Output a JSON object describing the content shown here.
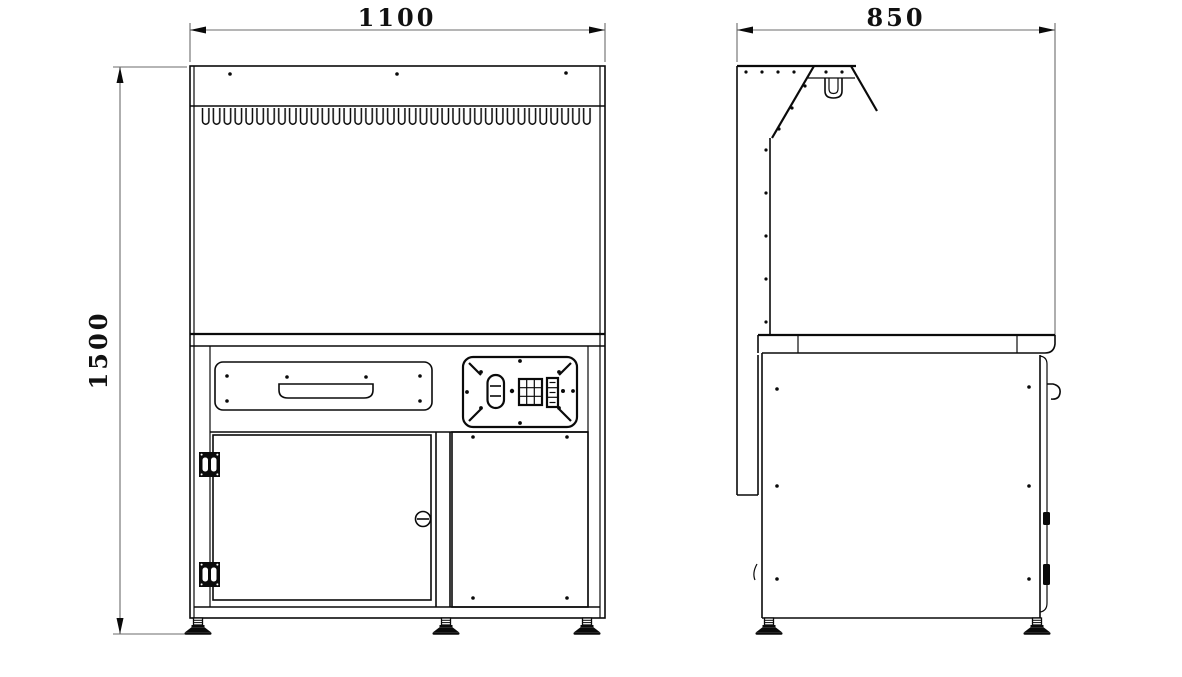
{
  "page": {
    "background": "#ffffff",
    "line_color": "#0a0a0a",
    "dimension_line_color": "#6b6b6b"
  },
  "drawing": {
    "kind": "orthographic technical drawing, fume-hood style laboratory cabinet, front and side views",
    "dimensions": {
      "front_width": "1100",
      "height": "1500",
      "side_depth": "850"
    },
    "front_view": {
      "vent_slot_count": 36,
      "top_panel_screw_count": 3,
      "drawer_screw_count": 4,
      "door_hinge_count": 2,
      "lock_count": 1,
      "leveling_feet_count": 3
    },
    "side_view": {
      "rivet_dot_rows": 3,
      "leveling_feet_count": 2
    }
  }
}
